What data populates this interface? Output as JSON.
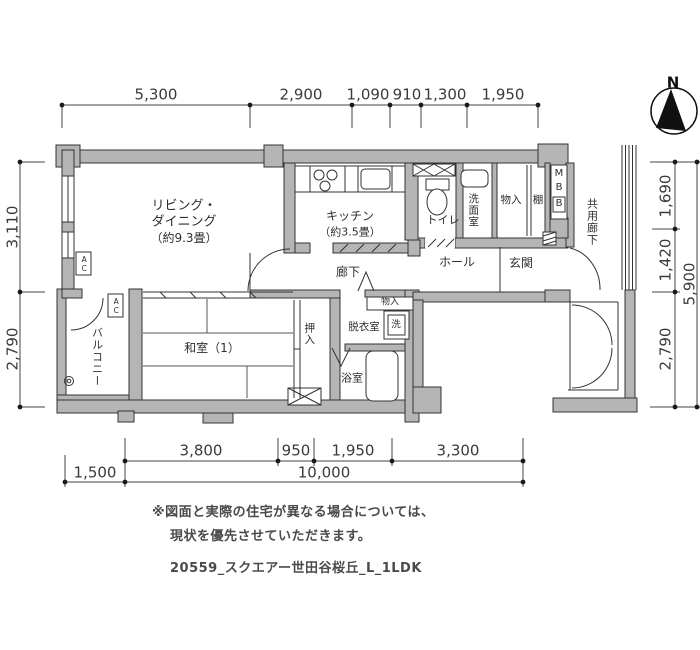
{
  "colors": {
    "background": "#ffffff",
    "wall_fill": "#b5b5b5",
    "line": "#333333",
    "text": "#2e2e2e",
    "note_text": "#4a4a4a"
  },
  "compass": {
    "north_label": "N"
  },
  "dimensions": {
    "top": [
      "5,300",
      "2,900",
      "1,090",
      "910",
      "1,300",
      "1,950"
    ],
    "left": [
      "3,110",
      "2,790"
    ],
    "right_inner": [
      "1,690",
      "1,420",
      "2,790"
    ],
    "right_outer": "5,900",
    "bottom_upper": [
      "3,800",
      "950",
      "1,950",
      "3,300"
    ],
    "bottom_lower": [
      "1,500",
      "10,000"
    ]
  },
  "rooms": {
    "living_dining": {
      "line1": "リビング・",
      "line2": "ダイニング",
      "line3": "（約9.3畳）"
    },
    "kitchen": {
      "line1": "キッチン",
      "line2": "（約3.5畳）"
    },
    "toilet": "トイレ",
    "washroom": "洗面室",
    "storage_upper": "物入",
    "shelf": "棚",
    "meter_box": {
      "m": "M",
      "b1": "B",
      "b2": "B"
    },
    "common_corridor": "共用廊下",
    "hall": "ホール",
    "entrance": "玄関",
    "corridor": "廊下",
    "storage_small": "物入",
    "dressing_room": "脱衣室",
    "washer": "洗",
    "closet": "押入",
    "japanese_room": "和室（1）",
    "bathroom": "浴室",
    "balcony": "バルコニー",
    "ac_left": "AC",
    "ac_balcony": "AC"
  },
  "notes": {
    "line1": "※図面と実際の住宅が異なる場合については、",
    "line2": "現状を優先させていただきます。",
    "line3": "20559_スクエアー世田谷桜丘_L_1LDK"
  }
}
